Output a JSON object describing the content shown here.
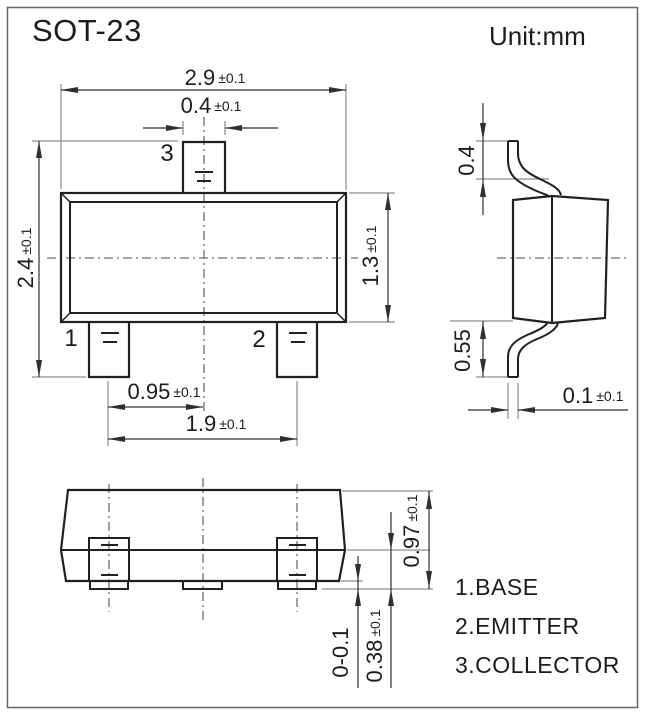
{
  "title": "SOT-23",
  "unit_label": "Unit:mm",
  "views": {
    "top": {
      "pins": {
        "p1": "1",
        "p2": "2",
        "p3": "3"
      },
      "dims": {
        "body_width": {
          "value": "2.9",
          "tol": "±0.1"
        },
        "lead_width": {
          "value": "0.4",
          "tol": "±0.1"
        },
        "overall_length": {
          "value": "2.4",
          "tol": "±0.1"
        },
        "body_length": {
          "value": "1.3",
          "tol": "±0.1"
        },
        "lead_pitch": {
          "value": "0.95",
          "tol": "±0.1"
        },
        "lead_span": {
          "value": "1.9",
          "tol": "±0.1"
        }
      }
    },
    "side": {
      "dims": {
        "lead_top_length": {
          "value": "0.4",
          "tol": ""
        },
        "lead_bottom_length": {
          "value": "0.55",
          "tol": ""
        },
        "lead_thickness": {
          "value": "0.1",
          "tol": "±0.1"
        }
      }
    },
    "front": {
      "dims": {
        "body_height": {
          "value": "0.97",
          "tol": "±0.1"
        },
        "standoff": {
          "value": "0-0.1",
          "tol": ""
        },
        "lead_foot_height": {
          "value": "0.38",
          "tol": "±0.1"
        }
      }
    }
  },
  "legend": {
    "items": [
      {
        "label": "1.BASE"
      },
      {
        "label": "2.EMITTER"
      },
      {
        "label": "3.COLLECTOR"
      }
    ]
  },
  "colors": {
    "outline": "#231f20",
    "dimension_line": "#2f2f2f",
    "extension_line": "#8c8c8c",
    "centerline": "#6e6e6e",
    "frame": "#666666",
    "text": "#1c1c1c",
    "background": "#ffffff"
  }
}
